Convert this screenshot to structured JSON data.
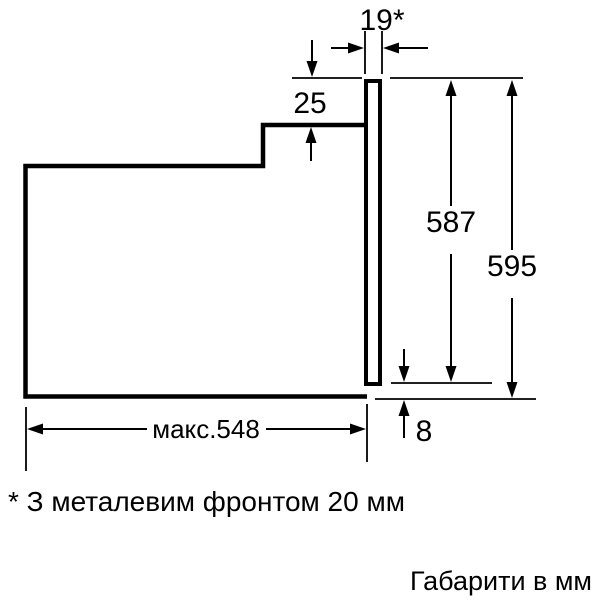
{
  "page": {
    "background": "#ffffff",
    "line_color": "#000000"
  },
  "diagram": {
    "type": "technical-dimension-drawing",
    "subject": "built-in-oven-side-profile",
    "dimensions": {
      "front_thickness": "19*",
      "top_overhang": "25",
      "front_height": "587",
      "total_height": "595",
      "bottom_gap": "8",
      "max_depth": "макс.548"
    },
    "footnote": "* З металевим фронтом 20 мм",
    "units_note": "Габарити в мм"
  }
}
